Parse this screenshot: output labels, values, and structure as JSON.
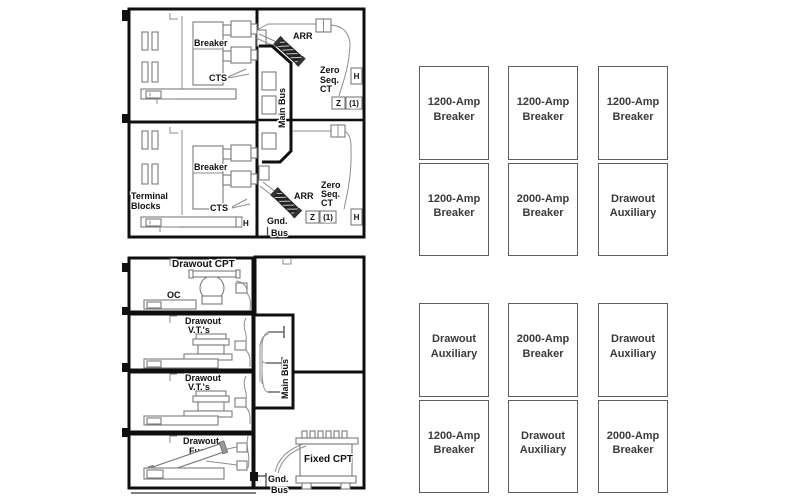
{
  "figure": {
    "section_views": {
      "main_bus_label": "Main Bus",
      "shared": {
        "h_label": "H",
        "z_label": "Z",
        "z_count_label": "(1)",
        "gnd": {
          "l1": "Gnd.",
          "l2": "Bus"
        }
      },
      "breaker_section": {
        "breaker_label": "Breaker",
        "cts_label": "CTS",
        "arr_label": "ARR",
        "zero_seq_ct": {
          "l1": "Zero",
          "l2": "Seq.",
          "l3": "CT"
        },
        "terminal_blocks": {
          "l1": "Terminal",
          "l2": "Blocks"
        }
      },
      "auxiliary_section": {
        "drawout_cpt_label": "Drawout CPT",
        "oc_bkr": {
          "l1": "OC",
          "l2": "Bkr."
        },
        "drawout_vts": {
          "l1": "Drawout",
          "l2": "V.T.'s"
        },
        "drawout_fuses": {
          "l1": "Drawout",
          "l2": "Fuses"
        },
        "fixed_cpt_label": "Fixed CPT"
      }
    },
    "lineups": {
      "top": {
        "cabinets": [
          {
            "upper": "1200-Amp\nBreaker",
            "lower": "1200-Amp\nBreaker"
          },
          {
            "upper": "1200-Amp\nBreaker",
            "lower": "2000-Amp\nBreaker"
          },
          {
            "upper": "1200-Amp\nBreaker",
            "lower": "Drawout\nAuxiliary"
          }
        ]
      },
      "bottom": {
        "cabinets": [
          {
            "upper": "Drawout\nAuxiliary",
            "lower": "1200-Amp\nBreaker"
          },
          {
            "upper": "2000-Amp\nBreaker",
            "lower": "Drawout\nAuxiliary"
          },
          {
            "upper": "Drawout\nAuxiliary",
            "lower": "2000-Amp\nBreaker"
          }
        ]
      }
    },
    "colors": {
      "diagram_line": "#0f0f0f",
      "detail_line": "#8d8d8d",
      "cabinet_border": "#5d5d5d",
      "cabinet_text": "#3a3a3a",
      "background": "#ffffff"
    }
  }
}
